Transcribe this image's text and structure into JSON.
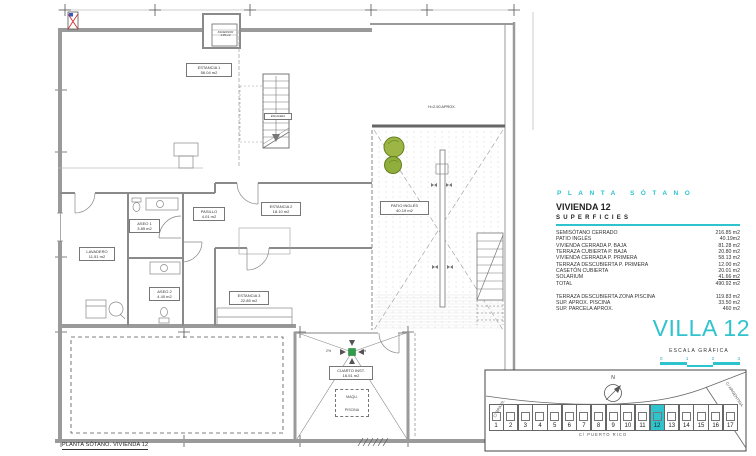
{
  "accent_color": "#2fc3ce",
  "plan_labels": {
    "estancia1": {
      "name": "ESTANCIA 1",
      "area": "56.04 m2"
    },
    "ascensor": {
      "name": "ASCENSOR",
      "area": "1.05 m2"
    },
    "escalera": "ESCALERA",
    "lavadero": {
      "name": "LAVADERO",
      "area": "11.51 m2"
    },
    "aseo1": {
      "name": "ASEO 1",
      "area": "3.85 m2"
    },
    "pasillo": {
      "name": "PASILLO",
      "area": "4.01 m2"
    },
    "estancia2": {
      "name": "ESTANCIA 2",
      "area": "18.10 m2"
    },
    "aseo2": {
      "name": "ASEO 2",
      "area": "4.40 m2"
    },
    "estancia3": {
      "name": "ESTANCIA 3",
      "area": "22.85 m2"
    },
    "patio": {
      "name": "PATIO INGLÉS",
      "area": "40.19 m2"
    },
    "height_note": "H=2.50 APROX.",
    "cuarto_inst": {
      "name": "CUARTO INST.",
      "area": "16.51 m2"
    },
    "maquinaria": {
      "line1": "MAQU.",
      "line2": "PISCINA"
    },
    "slope_left": "2%",
    "slope_right": "2%",
    "caption": "PLANTA SÓTANO. VIVIENDA 12"
  },
  "legend": {
    "plan_title": "PLANTA SÓTANO",
    "vivienda": "VIVIENDA 12",
    "superficies_title": "SUPERFICIES",
    "rows": [
      {
        "label": "SEMISÓTANO CERRADO",
        "value": "216.85 m2"
      },
      {
        "label": "PATIO INGLÉS",
        "value": "40.19m2"
      },
      {
        "label": "VIVIENDA CERRADA P. BAJA",
        "value": "81.28 m2"
      },
      {
        "label": "TERRAZA CUBIERTA P. BAJA",
        "value": "20.80 m2"
      },
      {
        "label": "VIVIENDA CERRADA P. PRIMERA",
        "value": "58.13 m2"
      },
      {
        "label": "TERRAZA DESCUBIERTA P. PRIMERA",
        "value": "12.00 m2"
      },
      {
        "label": "CASETÓN CUBIERTA",
        "value": "20.01 m2"
      },
      {
        "label": "SOLARIUM",
        "value": "41.66 m2",
        "underline": true
      },
      {
        "label": "TOTAL",
        "value": "490.92 m2"
      }
    ],
    "extra_rows": [
      {
        "label": "TERRAZA DESCUBIERTA  ZONA PISCINA",
        "value": "119.83 m2"
      },
      {
        "label": "SUP.  APROX.  PISCINA",
        "value": "33.50 m2"
      },
      {
        "label": "SUP. PARCELA APROX.",
        "value": "460 m2"
      }
    ],
    "villa_title": "VILLA 12",
    "escala_label": "ESCALA GRÁFICA",
    "escala_ticks": [
      "0",
      "1",
      "2",
      "3"
    ]
  },
  "siteplan": {
    "plots": [
      "1",
      "2",
      "3",
      "4",
      "5",
      "6",
      "7",
      "8",
      "9",
      "10",
      "11",
      "12",
      "13",
      "14",
      "15",
      "16",
      "17"
    ],
    "highlighted": "12",
    "street_bottom": "C/  PUERTO RICO",
    "street_left": "C/  BRASIL",
    "street_right": "C/  ARGENTINA",
    "north": "N"
  }
}
